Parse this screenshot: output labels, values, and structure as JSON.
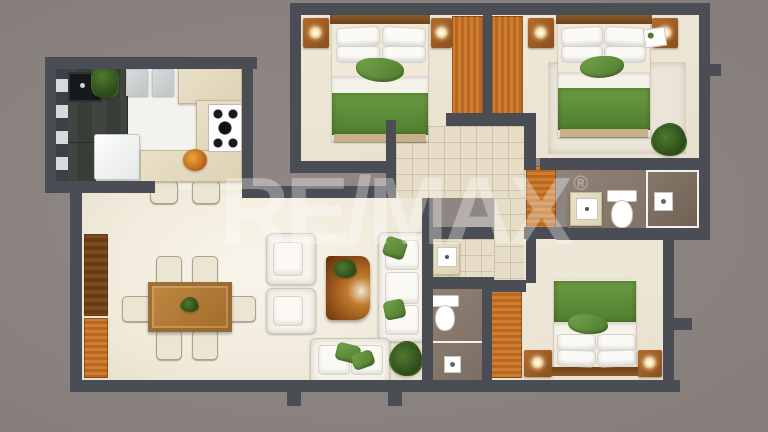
{
  "watermark": {
    "brand": "RE/MAX",
    "registered": "®"
  },
  "palette": {
    "wall": "#4a4e54",
    "background": "#8b8380",
    "floor_living": "#f2ecde",
    "floor_bedroom": "#ece4d3",
    "floor_tile": "#e6ddc7",
    "floor_bath": "#84766a",
    "wood_orange": "#c9772e",
    "wood_table": "#b5803f",
    "bed_green": "#5f8f3e",
    "upholstery_white": "#f6f3ec",
    "counter_dark": "#3d423c"
  }
}
